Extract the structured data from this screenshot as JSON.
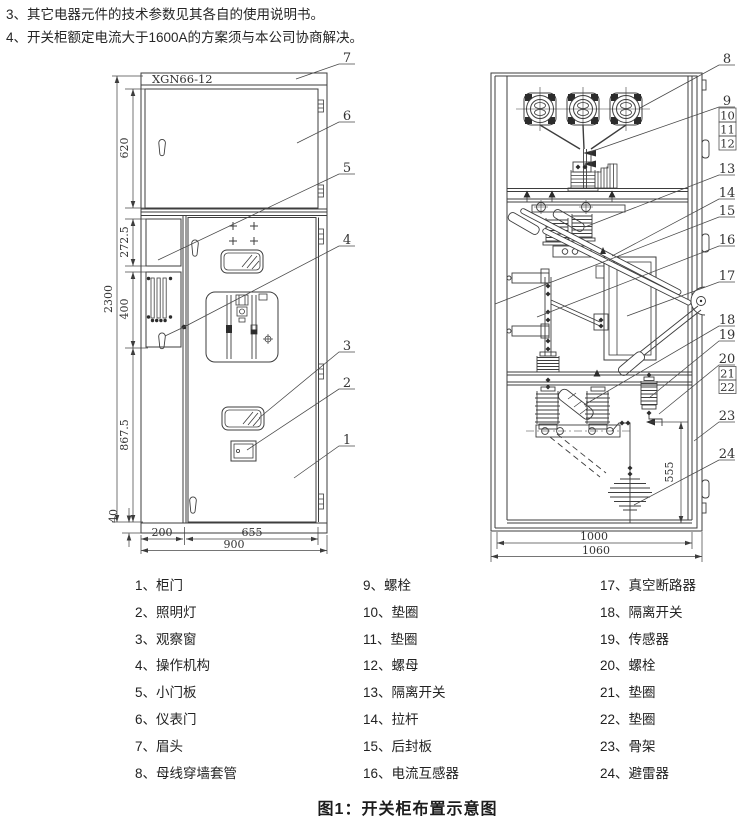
{
  "notes": {
    "line_3": "3、其它电器元件的技术参数见其各自的使用说明书。",
    "line_4": "4、开关柜额定电流大于1600A的方案须与本公司协商解决。"
  },
  "front_view": {
    "model_label": "XGN66-12",
    "dims": {
      "meter_door_height": "620",
      "small_panel_height": "272.5",
      "vent_panel_height": "400",
      "total_height": "2300",
      "lower_height": "867.5",
      "base_height": "40",
      "left_col_width": "200",
      "door_width": "655",
      "total_width": "900"
    },
    "callouts": [
      "7",
      "6",
      "5",
      "4",
      "3",
      "2",
      "1"
    ]
  },
  "side_view": {
    "dims": {
      "arrester_height": "555",
      "inner_depth": "1000",
      "total_depth": "1060"
    },
    "callouts": [
      "8",
      "9",
      "10",
      "11",
      "12",
      "13",
      "14",
      "15",
      "16",
      "17",
      "18",
      "19",
      "20",
      "21",
      "22",
      "23",
      "24"
    ]
  },
  "legend": {
    "columns": [
      [
        "1、柜门",
        "2、照明灯",
        "3、观察窗",
        "4、操作机构",
        "5、小门板",
        "6、仪表门",
        "7、眉头",
        "8、母线穿墙套管"
      ],
      [
        "9、螺栓",
        "10、垫圈",
        "11、垫圈",
        "12、螺母",
        "13、隔离开关",
        "14、拉杆",
        "15、后封板",
        "16、电流互感器"
      ],
      [
        "17、真空断路器",
        "18、隔离开关",
        "19、传感器",
        "20、螺栓",
        "21、垫圈",
        "22、垫圈",
        "23、骨架",
        "24、避雷器"
      ]
    ]
  },
  "caption": "图1：开关柜布置示意图"
}
